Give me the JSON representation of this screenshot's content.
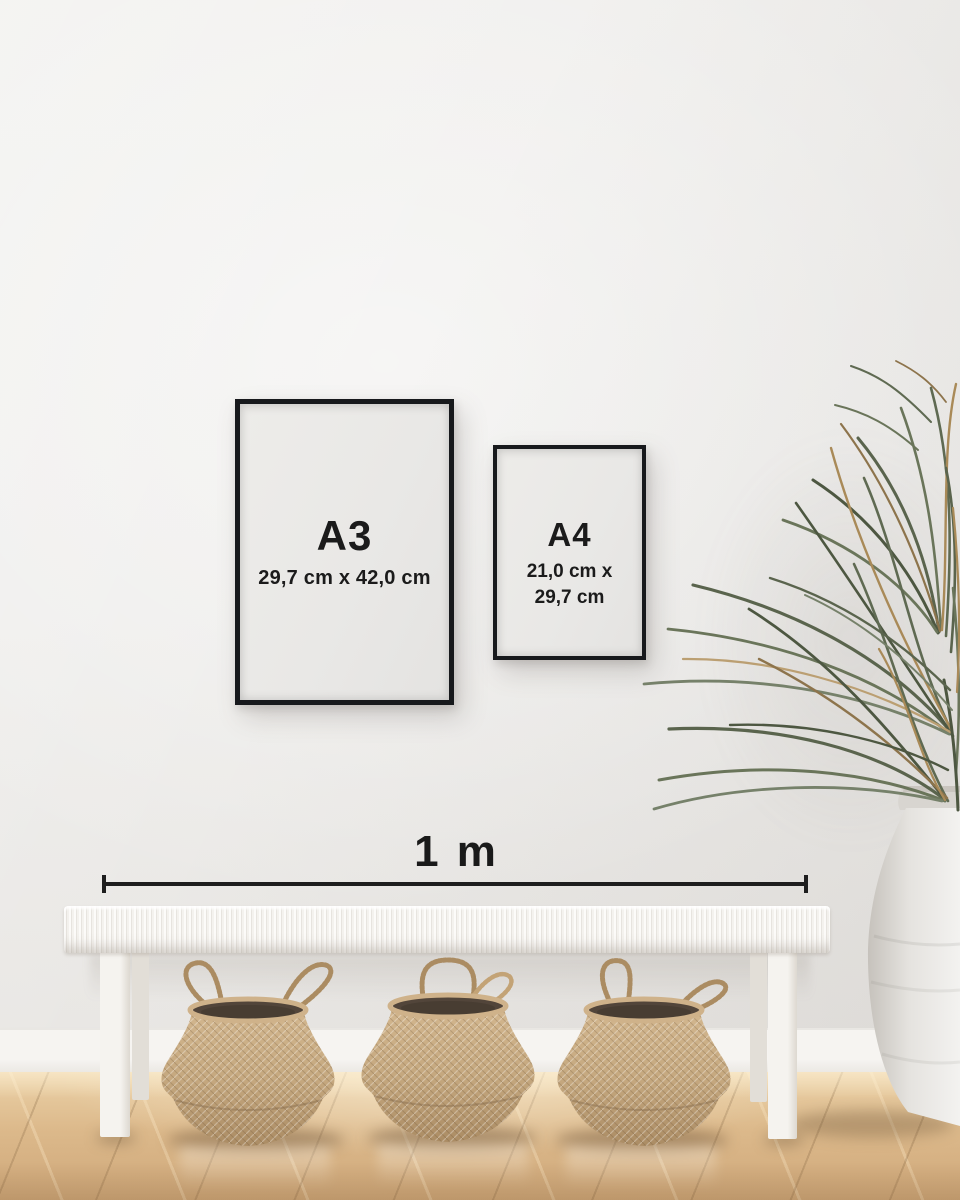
{
  "frames": {
    "a3": {
      "label": "A3",
      "dimensions": "29,7 cm x 42,0 cm"
    },
    "a4": {
      "label": "A4",
      "dimensions_line1": "21,0 cm x",
      "dimensions_line2": "29,7 cm"
    }
  },
  "scale_bar": {
    "label": "1 m"
  },
  "colors": {
    "wall": "#efeeec",
    "baseboard": "#f5f3f0",
    "floor_light": "#ecd2a8",
    "floor_dark": "#cfa87a",
    "frame_border": "#17191c",
    "frame_paper": "#e9e8e6",
    "label_text": "#1b1b1b",
    "scale_line": "#1e1e1e",
    "bench_white": "#f4f2ee",
    "basket_tan": "#c6aa81",
    "basket_opening": "#52453a",
    "vase_white": "#efedea",
    "plant_green": "#5a644d",
    "plant_brown": "#a98a58"
  },
  "scene_objects": [
    "a3-frame",
    "a4-frame",
    "scale-bar",
    "palm-plant",
    "ceramic-vase",
    "woven-bench",
    "seagrass-basket-left",
    "seagrass-basket-middle",
    "seagrass-basket-right",
    "wood-floor",
    "baseboard",
    "wall"
  ]
}
